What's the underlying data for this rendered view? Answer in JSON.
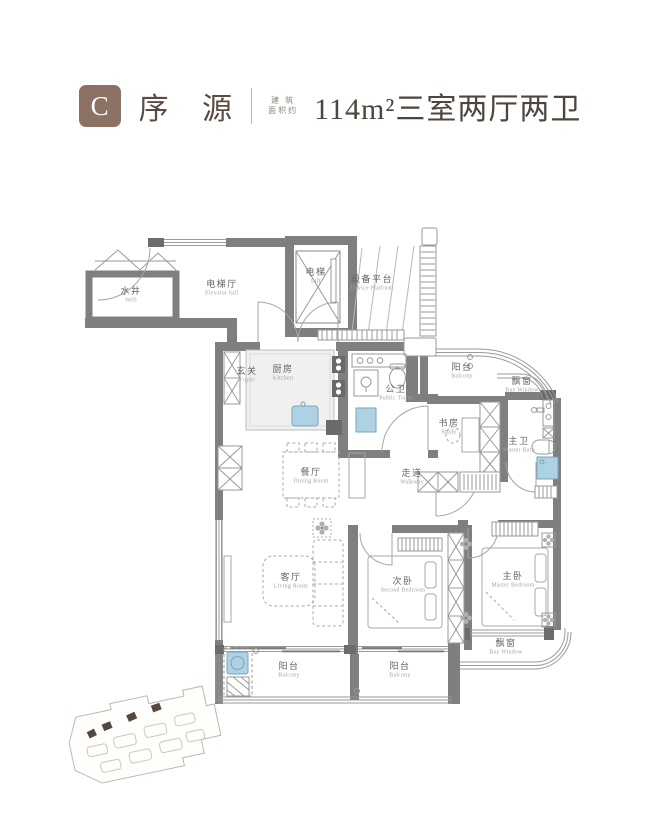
{
  "header": {
    "badge": "C",
    "title": "序 源",
    "area_note_line1": "建 筑",
    "area_note_line2": "面积约",
    "area_value": "114m²",
    "spec": "三室两厅两卫",
    "accent_color": "#8b7264"
  },
  "rooms": {
    "well": {
      "zh": "水井",
      "en": "Well"
    },
    "elevator_hall": {
      "zh": "电梯厅",
      "en": "Elevator hall"
    },
    "lift": {
      "zh": "电梯",
      "en": "Lift"
    },
    "device_platform": {
      "zh": "设备平台",
      "en": "Device Platform"
    },
    "foyer": {
      "zh": "玄关",
      "en": "Foyer"
    },
    "kitchen": {
      "zh": "厨房",
      "en": "Kitchen"
    },
    "public_toilet": {
      "zh": "公卫",
      "en": "Public Toilet"
    },
    "balcony_top": {
      "zh": "阳台",
      "en": "Balcony"
    },
    "bay_window_right": {
      "zh": "飘窗",
      "en": "Bay Window"
    },
    "study": {
      "zh": "书房",
      "en": "Study"
    },
    "master_bath": {
      "zh": "主卫",
      "en": "Master Bath"
    },
    "dining": {
      "zh": "餐厅",
      "en": "Dining Room"
    },
    "walkway": {
      "zh": "走道",
      "en": "Walkway"
    },
    "living": {
      "zh": "客厅",
      "en": "Living Room"
    },
    "second_bedroom": {
      "zh": "次卧",
      "en": "Second Bedroom"
    },
    "master_bedroom": {
      "zh": "主卧",
      "en": "Master Bedroom"
    },
    "balcony_bottom_left": {
      "zh": "阳台",
      "en": "Balcony"
    },
    "balcony_bottom_right": {
      "zh": "阳台",
      "en": "Balcony"
    },
    "bay_window_bottom": {
      "zh": "飘窗",
      "en": "Bay Window"
    }
  }
}
